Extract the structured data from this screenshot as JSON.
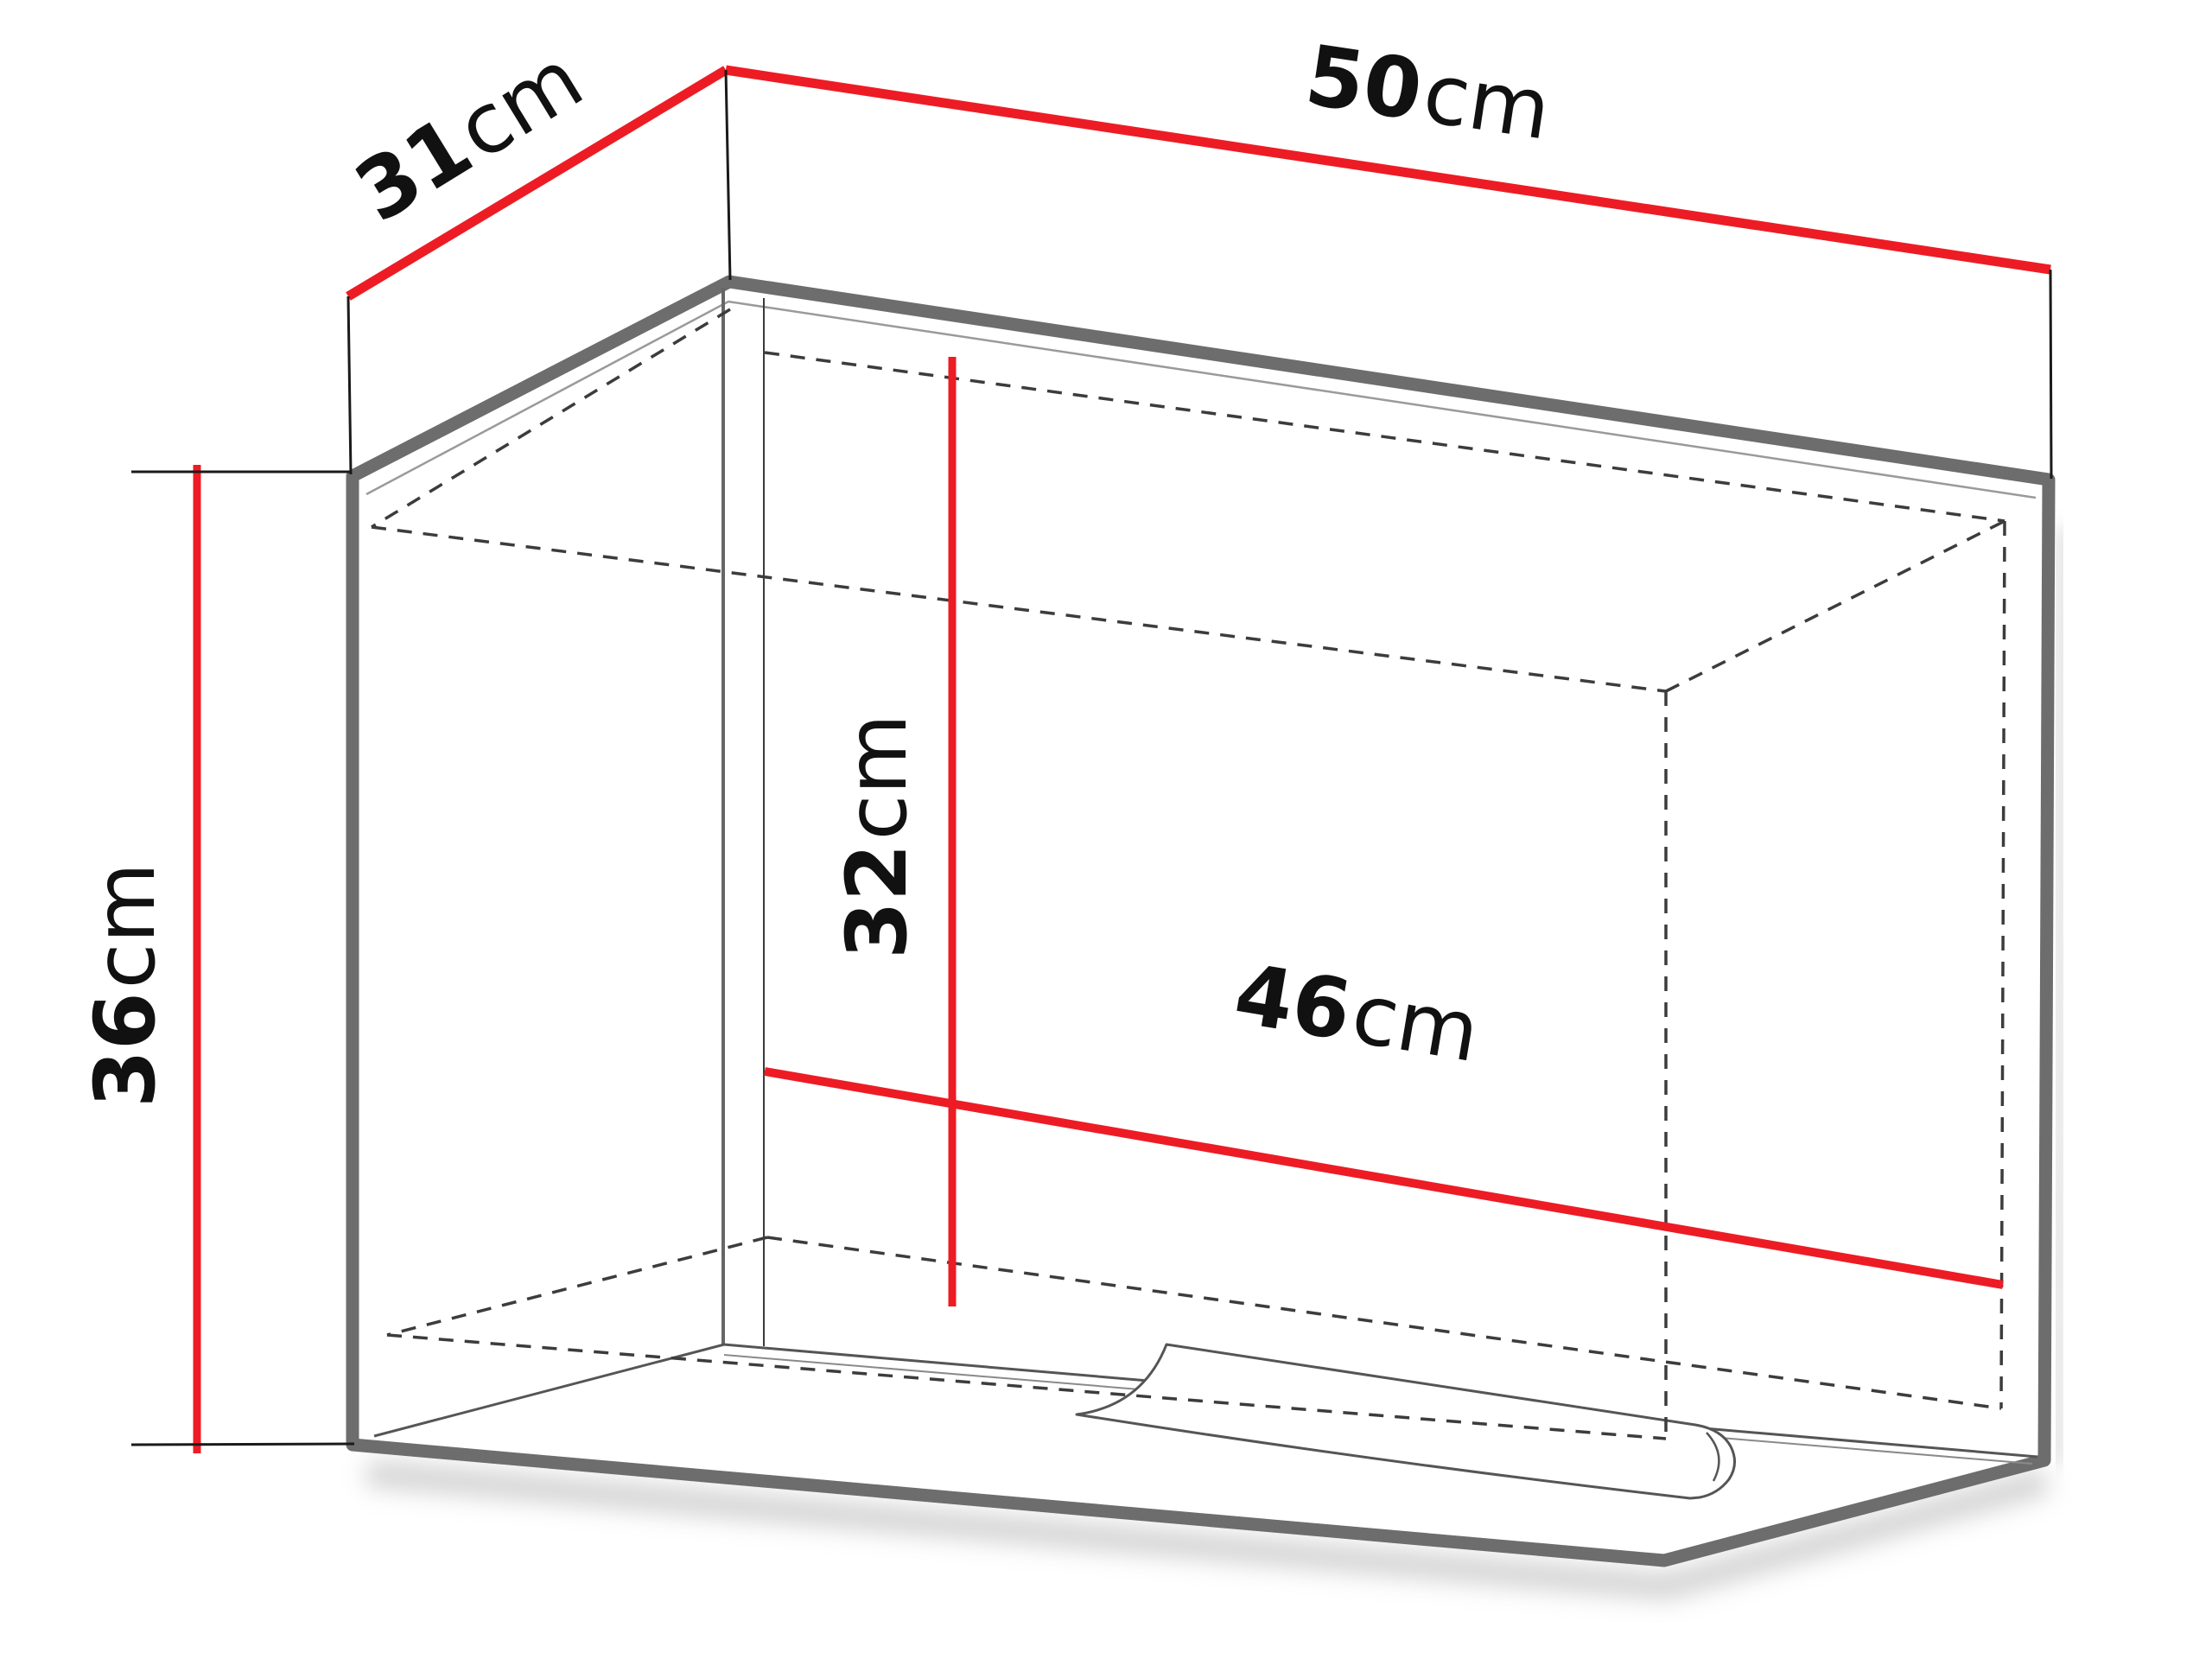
{
  "diagram": {
    "kind": "furniture-dimension-diagram",
    "dimensions": {
      "width": {
        "value": "50",
        "unit": "cm"
      },
      "depth": {
        "value": "31",
        "unit": "cm"
      },
      "height": {
        "value": "36",
        "unit": "cm"
      },
      "inner_width": {
        "value": "46",
        "unit": "cm"
      },
      "inner_height": {
        "value": "32",
        "unit": "cm"
      }
    },
    "colors": {
      "dimension_line": "#ed1c24",
      "extension_line": "#1a1a1a",
      "outline": "#6d6d6d",
      "hidden_line": "#3c3c3c",
      "label_text": "#111111",
      "background": "#ffffff"
    }
  }
}
